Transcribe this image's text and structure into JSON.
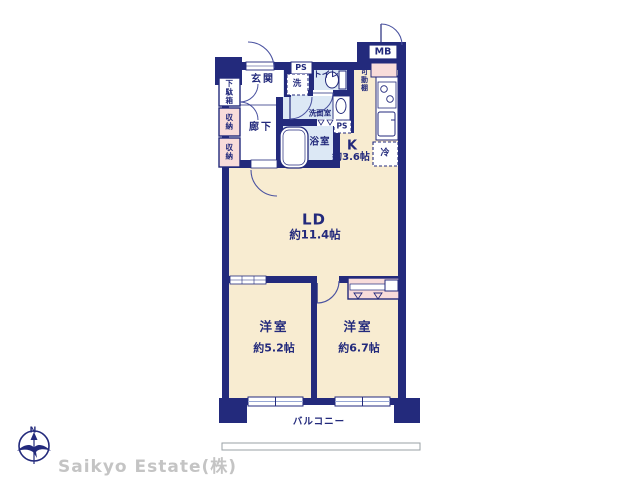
{
  "floorplan": {
    "entrance": {
      "label": "玄関"
    },
    "hallway": {
      "label": "廊下"
    },
    "shoe_box": {
      "label": "下駄箱"
    },
    "storage_upper": {
      "label": "収納"
    },
    "storage_lower": {
      "label": "収納"
    },
    "pipe_space_top": {
      "label": "PS"
    },
    "pipe_space_mid": {
      "label": "PS"
    },
    "washing_machine": {
      "label": "洗"
    },
    "toilet": {
      "label": "トイレ"
    },
    "washroom": {
      "label": "洗面室"
    },
    "bathroom": {
      "label": "浴室"
    },
    "movable_shelf": {
      "label": "可動棚"
    },
    "meter_box": {
      "label": "MB"
    },
    "refrigerator": {
      "label": "冷"
    },
    "kitchen": {
      "label": "K",
      "size": "約3.6帖"
    },
    "living_dining": {
      "label": "LD",
      "size": "約11.4帖"
    },
    "bedroom_left": {
      "label": "洋室",
      "size": "約5.2帖"
    },
    "bedroom_right": {
      "label": "洋室",
      "size": "約6.7帖"
    },
    "balcony": {
      "label": "バルコニー"
    }
  },
  "branding": {
    "company": "Saikyo Estate(株)",
    "compass_north": "N"
  },
  "icons": {
    "compass": "compass-north-icon",
    "bathtub": "bathtub-icon",
    "toilet_bowl": "toilet-bowl-icon",
    "vanity_sink": "vanity-sink-icon",
    "stove": "stove-burners-icon",
    "kitchen_sink": "kitchen-sink-icon",
    "hangers": "closet-hanger-icon"
  },
  "colors": {
    "wall_navy": "#232a7c",
    "room_cream": "#f8ecd1",
    "wet_blue": "#dce8f5",
    "storage_pink": "#f8dcda",
    "logo_gray": "#c4c4c4"
  }
}
